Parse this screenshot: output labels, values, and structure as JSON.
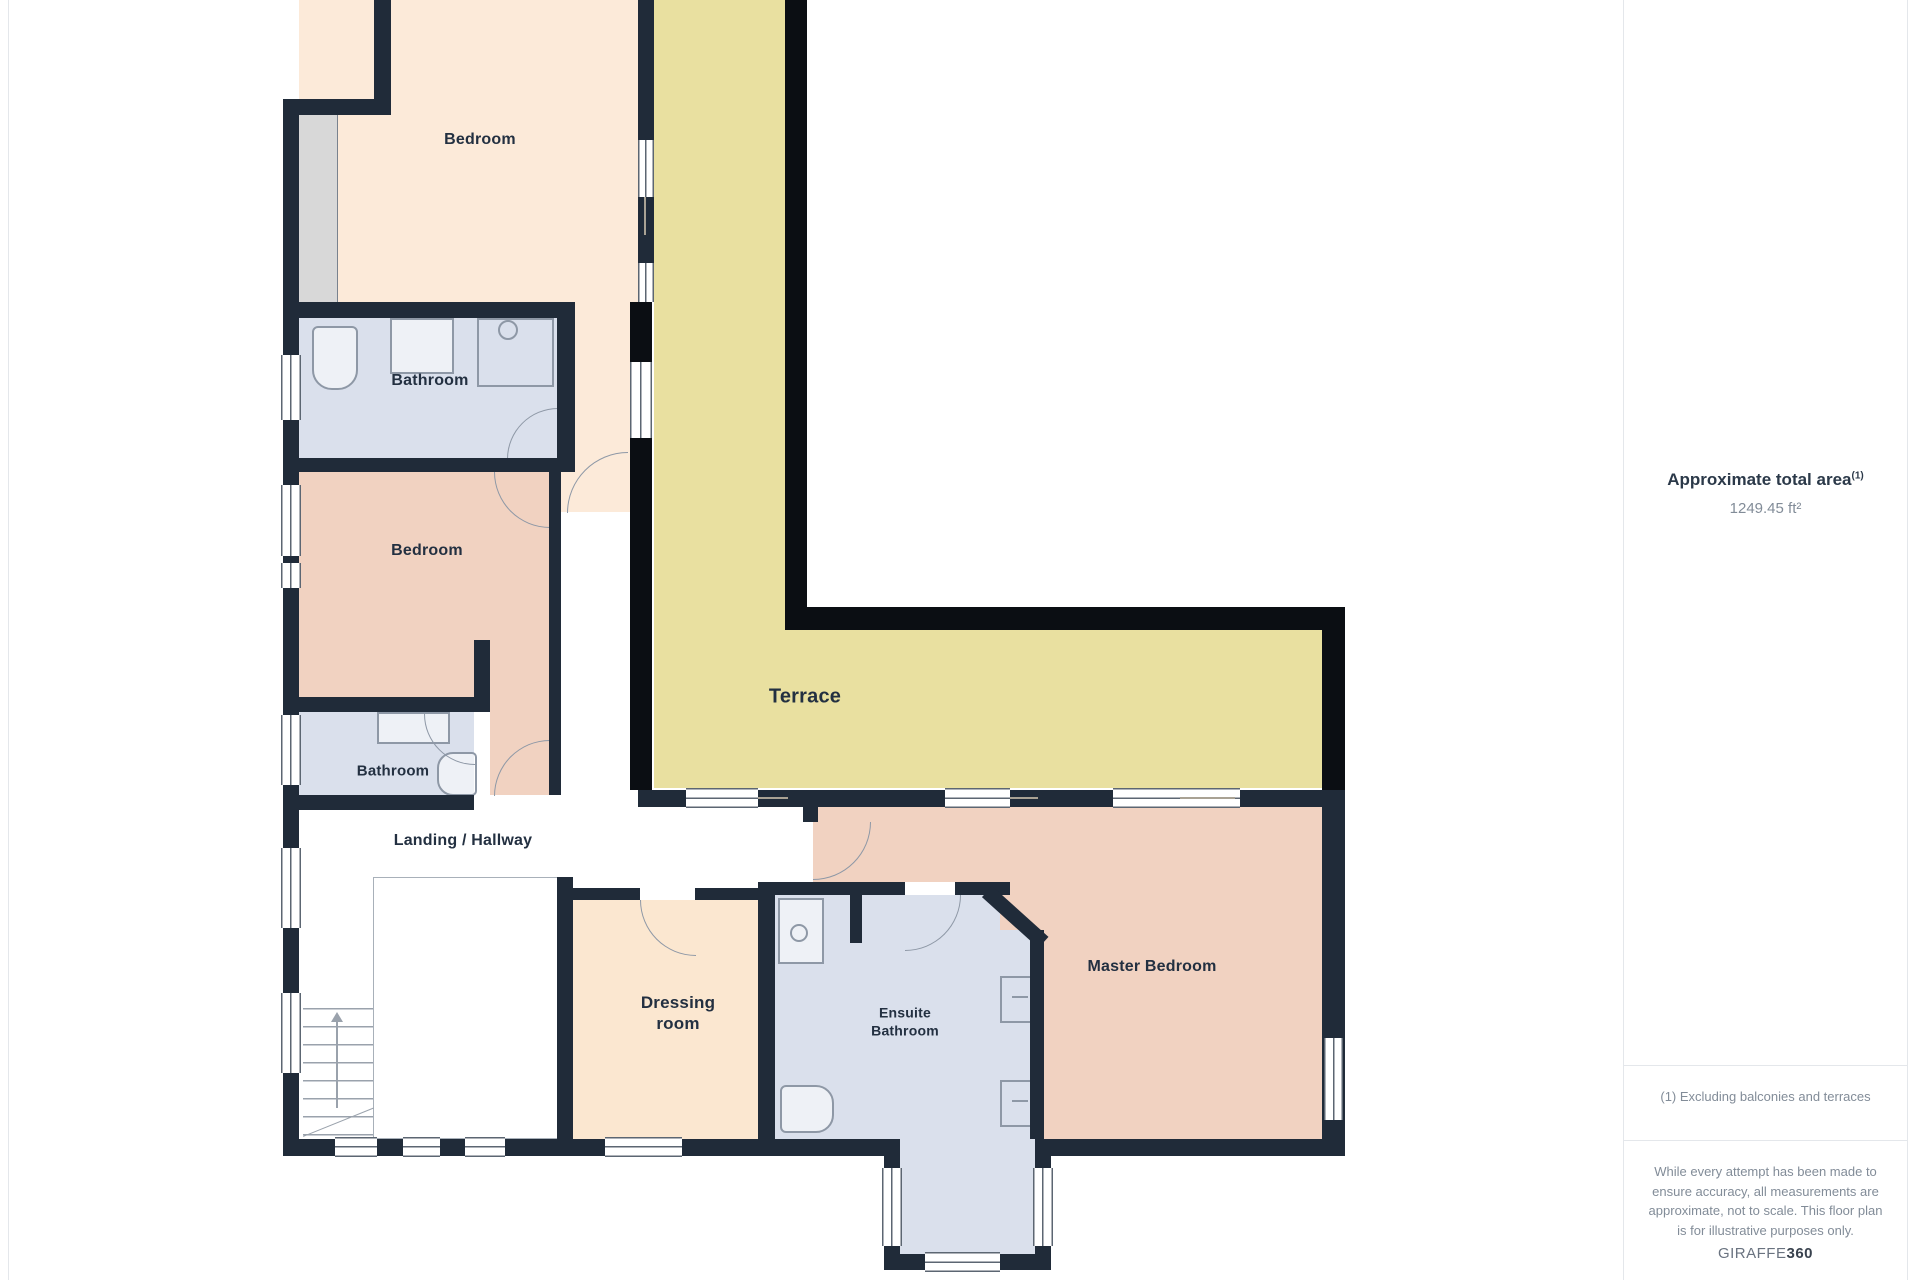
{
  "sidebar": {
    "title": "Approximate total area",
    "title_superscript": "(1)",
    "area_value": "1249.45 ft²",
    "footnote": "(1) Excluding balconies and terraces",
    "disclaimer": "While every attempt has been made to ensure accuracy, all measurements are approximate, not to scale. This floor plan is for illustrative purposes only.",
    "brand_name": "GIRAFFE",
    "brand_suffix": "360"
  },
  "floorplan": {
    "labels": {
      "bedroom1": "Bedroom",
      "bathroom1": "Bathroom",
      "bedroom2": "Bedroom",
      "bathroom2": "Bathroom",
      "landing": "Landing / Hallway",
      "terrace": "Terrace",
      "dressing_line1": "Dressing",
      "dressing_line2": "room",
      "ensuite_line1": "Ensuite",
      "ensuite_line2": "Bathroom",
      "master": "Master Bedroom"
    },
    "colors": {
      "wall": "#202b39",
      "terrace_wall": "#0b0e13",
      "bedroom_fill": "#fcead9",
      "salmon_fill": "#f1d2c1",
      "bathroom_fill": "#dae0ec",
      "dressing_fill": "#fbe7d0",
      "terrace_fill": "#e9e0a0",
      "window_line": "#5c6672",
      "fixture_line": "#8e98a6",
      "label_text": "#233041",
      "sidebar_title": "#2b3949",
      "sidebar_muted": "#828c98",
      "divider": "#e4e7eb",
      "brand": "#39424e",
      "wardrobe_fill": "#d8d8d8"
    }
  }
}
